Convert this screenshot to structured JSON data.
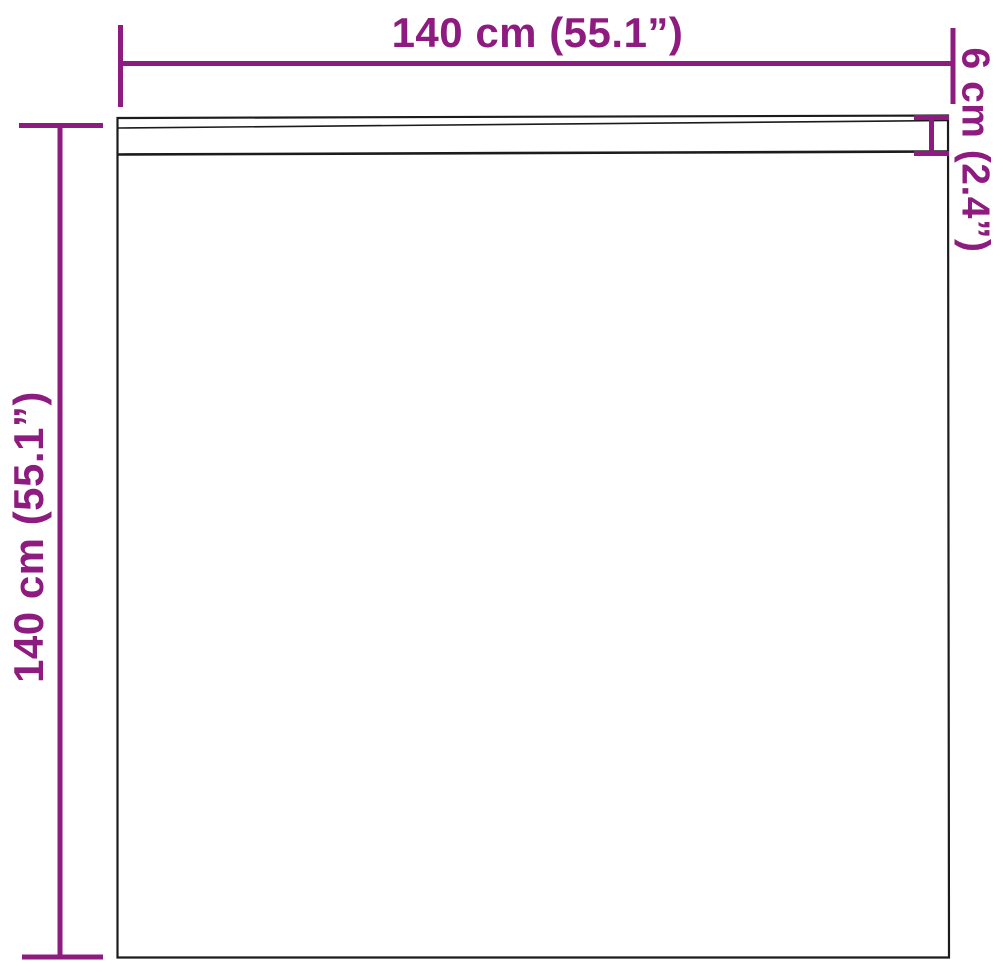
{
  "diagram": {
    "colors": {
      "accent": "#8E1B7F",
      "outline": "#1C1C1C",
      "background": "#FFFFFF"
    },
    "labels": {
      "width": "140 cm (55.1”)",
      "height": "140 cm (55.1”)",
      "header_height": "6 cm (2.4”)"
    }
  }
}
